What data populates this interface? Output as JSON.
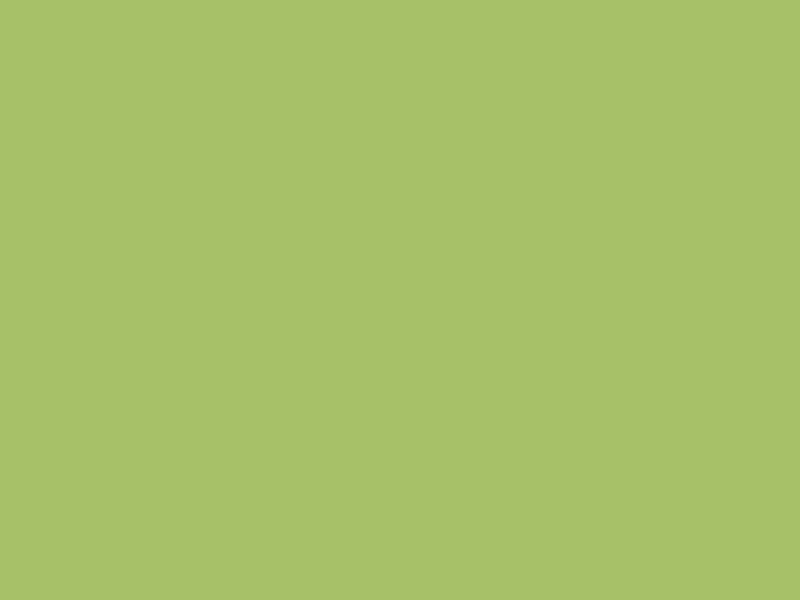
{
  "scene": {
    "title": "Aerial 3D rendering of a community park masterplan",
    "type": "architectural-render",
    "features": [
      "main road with dashed centerline",
      "side road branches",
      "entry drive",
      "park block with red jogging track",
      "children playground",
      "splash pad pool",
      "two white tensile shade canopies",
      "basketball court complex",
      "blue art court",
      "clubhouse building",
      "upper teal fitness pad",
      "lower teal fitness pad",
      "curved white walking paths",
      "dense forest",
      "parking lot with stalls",
      "blue monument sign"
    ]
  },
  "palette": {
    "grass": "#a7c266",
    "grassLight": "#b6ce78",
    "grassPale": "#c8da8e",
    "parkGrass": "#90b656",
    "forestGreens": [
      "#3f6b33",
      "#4e7c3c",
      "#5f9247",
      "#6fa455",
      "#83b368",
      "#97c17d",
      "#a9cb93"
    ],
    "paleGreens": [
      "#b7cfa4",
      "#c6d8b6",
      "#9fbe8a"
    ],
    "autumn": [
      "#cf8a3e",
      "#c27a35"
    ],
    "purpleTree": "#5c5674",
    "whiteBloom": "#e7eadf",
    "redBloom": "#b4494f",
    "pinkBloom": "#c79ab3",
    "lilacBloom": "#b4a3cc",
    "road": "#6f7377",
    "roadLight": "#8b8f93",
    "roadEdge": "#e9ecef",
    "sidewalk": "#d4d7da",
    "asphalt": "#3c3f45",
    "stall": "#e2e6ea",
    "courtPink": "#c4737a",
    "courtPinkLight": "#cd8389",
    "courtLine": "#f2e9e6",
    "courtKey": "#7cbb50",
    "courtBlue": "#3d85c2",
    "courtYellow": "#e5bf45",
    "fence": "#36413a",
    "teal": "#57bead",
    "tealDark": "#3f9e8f",
    "equip": "#24322c",
    "track": "#b5525b",
    "path": "#e9ece4",
    "canopy": "#f3f4f1",
    "canopyShade": "#d8dad4",
    "pool": "#2f7fc4",
    "poolDeck": "#8ecae8",
    "playYellow": "#e3c14a",
    "playOrange": "#dd8f3c",
    "playGreen": "#7ec457",
    "roof": "#94979b",
    "roofDark": "#7e8185",
    "wall": "#edeff1",
    "sign": "#2743c8"
  },
  "inventory": {
    "basketball_courts_pink": 5,
    "art_court_blue": 1,
    "shade_canopies": 2,
    "fitness_pads_teal": 2,
    "parking_rows": 3,
    "buildings": 1,
    "monument_signs": 1
  },
  "trees": {
    "forest_top": 95,
    "forest_right": 54,
    "forest_center": 38,
    "park": 26,
    "court_edge_row": 12,
    "court_west_row": 5,
    "parking_row": 11,
    "paver_row": 6
  },
  "equipment": {
    "upper_pad_pieces": 16,
    "lower_pad_pieces": 18
  },
  "cars": [
    {
      "name": "white-car",
      "color": "#eef0f2",
      "x": 44,
      "y": 470,
      "angle": 77
    },
    {
      "name": "cream-car",
      "color": "#e9e3bb",
      "x": 16,
      "y": 512,
      "angle": 77
    },
    {
      "name": "blue-car",
      "color": "#2e6fd0",
      "x": 88,
      "y": 530,
      "angle": 77
    },
    {
      "name": "green-car",
      "color": "#4c7d52",
      "x": 36,
      "y": 583,
      "angle": 77
    },
    {
      "name": "gray-suv",
      "color": "#33363b",
      "x": 345,
      "y": 497,
      "angle": 77
    },
    {
      "name": "brown-car",
      "color": "#4b3c33",
      "x": 330,
      "y": 541,
      "angle": 77
    },
    {
      "name": "green-suv",
      "color": "#47784d",
      "x": 268,
      "y": 536,
      "angle": 77
    },
    {
      "name": "blue-van",
      "color": "#2b6fd4",
      "x": 226,
      "y": 566,
      "angle": 77
    },
    {
      "name": "white-van",
      "color": "#e8eaec",
      "x": 276,
      "y": 579,
      "angle": 77
    },
    {
      "name": "blue-car-2",
      "color": "#2f6fc9",
      "x": 432,
      "y": 556,
      "angle": 72
    }
  ]
}
